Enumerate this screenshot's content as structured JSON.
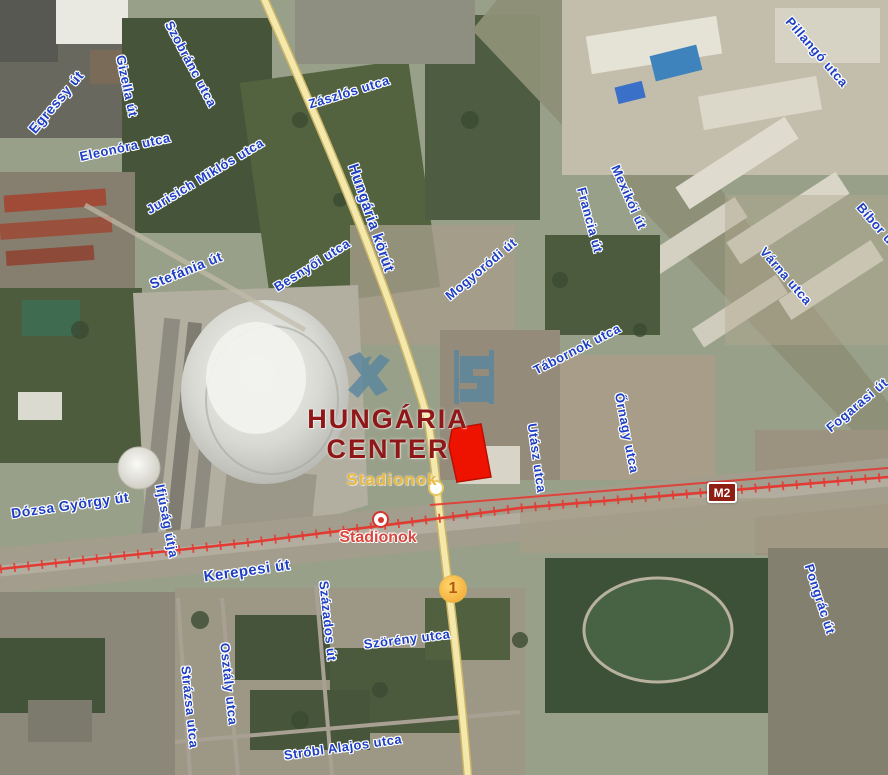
{
  "map": {
    "landmark": {
      "line1": "HUNGÁRIA",
      "line2": "CENTER"
    },
    "road_station_label": "Stadionok",
    "station": {
      "name": "Stadionok"
    },
    "metro_badge": "M2",
    "route_marker": "1",
    "colors": {
      "street_label_blue": "#1e3fc4",
      "landmark_red": "#8f1717",
      "station_text_red": "#da453c",
      "stadionok_yellow": "#eab93d",
      "metro_badge_bg": "#8e1d12",
      "parcel_red": "#ee1300",
      "road_yellow": "#f4e9ab",
      "railway_red": "#e23b33"
    },
    "street_labels": [
      {
        "t": "Egressy út",
        "x": 56,
        "y": 102,
        "r": -50,
        "s": 14
      },
      {
        "t": "Szobránc utca",
        "x": 191,
        "y": 64,
        "r": 62,
        "s": 13
      },
      {
        "t": "Gizella út",
        "x": 127,
        "y": 86,
        "r": 78,
        "s": 13
      },
      {
        "t": "Eleonóra utca",
        "x": 125,
        "y": 147,
        "r": -12,
        "s": 13
      },
      {
        "t": "Jurisich Miklós utca",
        "x": 205,
        "y": 176,
        "r": -31,
        "s": 13
      },
      {
        "t": "Zászlós utca",
        "x": 349,
        "y": 92,
        "r": -17,
        "s": 13
      },
      {
        "t": "Hungária körút",
        "x": 371,
        "y": 218,
        "r": 71,
        "s": 15
      },
      {
        "t": "Pillangó utca",
        "x": 817,
        "y": 52,
        "r": 49,
        "s": 13
      },
      {
        "t": "Mexikói út",
        "x": 629,
        "y": 197,
        "r": 66,
        "s": 13
      },
      {
        "t": "Francia út",
        "x": 590,
        "y": 220,
        "r": 75,
        "s": 13
      },
      {
        "t": "Mogyoródi út",
        "x": 481,
        "y": 269,
        "r": -40,
        "s": 13
      },
      {
        "t": "Várna utca",
        "x": 786,
        "y": 276,
        "r": 49,
        "s": 13
      },
      {
        "t": "Bíbor utca",
        "x": 882,
        "y": 231,
        "r": 49,
        "s": 13
      },
      {
        "t": "Fogarasi út",
        "x": 857,
        "y": 405,
        "r": -40,
        "s": 13
      },
      {
        "t": "Stefánia út",
        "x": 186,
        "y": 270,
        "r": -22,
        "s": 14
      },
      {
        "t": "Besnyői utca",
        "x": 312,
        "y": 265,
        "r": -32,
        "s": 13
      },
      {
        "t": "Tábornok utca",
        "x": 577,
        "y": 349,
        "r": -27,
        "s": 13
      },
      {
        "t": "Utász utca",
        "x": 537,
        "y": 458,
        "r": 82,
        "s": 13
      },
      {
        "t": "Őrnagy utca",
        "x": 627,
        "y": 433,
        "r": 79,
        "s": 13
      },
      {
        "t": "Dózsa György út",
        "x": 70,
        "y": 505,
        "r": -8,
        "s": 14
      },
      {
        "t": "Ifjúság útja",
        "x": 167,
        "y": 521,
        "r": 79,
        "s": 13
      },
      {
        "t": "Kerepesi út",
        "x": 247,
        "y": 571,
        "r": -8,
        "s": 15
      },
      {
        "t": "Százados út",
        "x": 328,
        "y": 621,
        "r": 84,
        "s": 13
      },
      {
        "t": "Szörény utca",
        "x": 407,
        "y": 639,
        "r": -7,
        "s": 13
      },
      {
        "t": "Osztály utca",
        "x": 229,
        "y": 684,
        "r": 84,
        "s": 13
      },
      {
        "t": "Strázsa utca",
        "x": 190,
        "y": 707,
        "r": 84,
        "s": 13
      },
      {
        "t": "Stróbl Alajos utca",
        "x": 343,
        "y": 747,
        "r": -8,
        "s": 13
      },
      {
        "t": "Pongrác út",
        "x": 820,
        "y": 599,
        "r": 72,
        "s": 13
      }
    ]
  }
}
